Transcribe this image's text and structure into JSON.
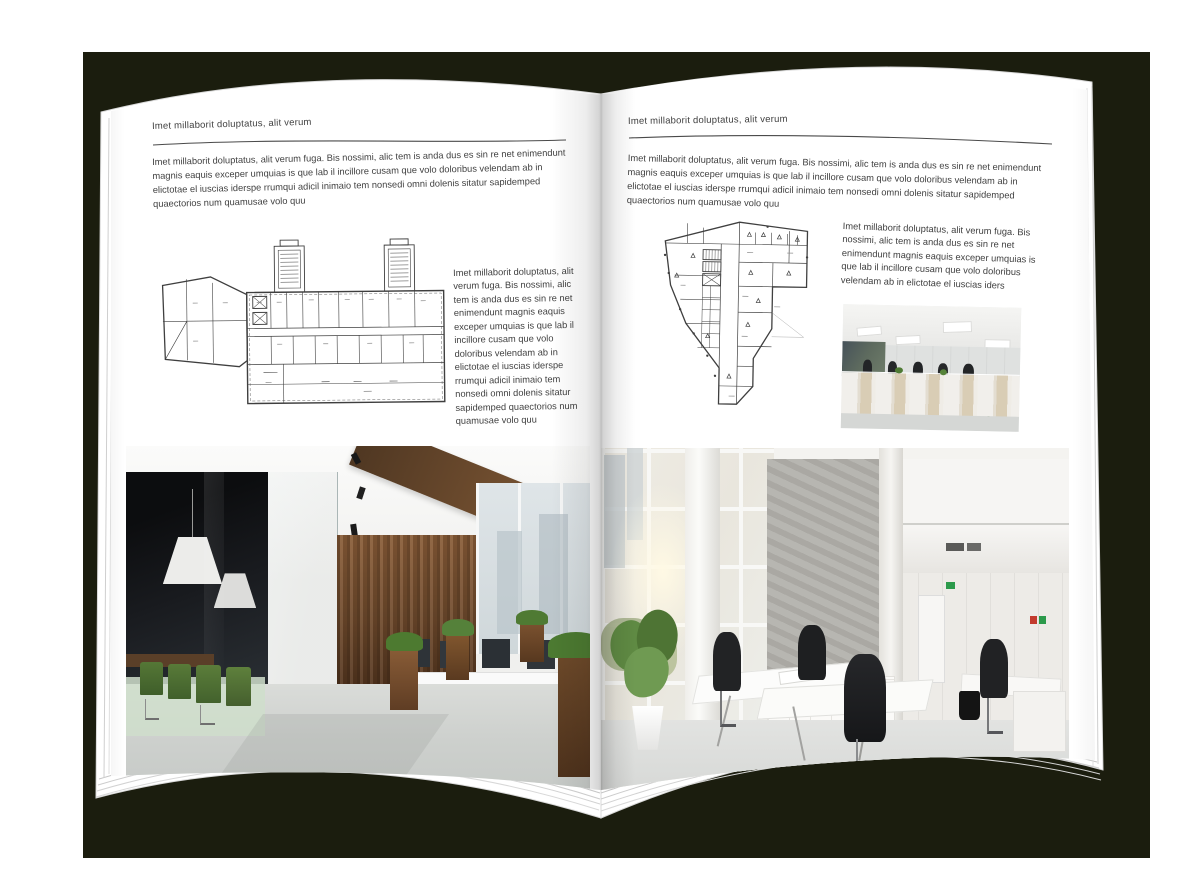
{
  "mockup": {
    "kind": "open-brochure-spread",
    "colors": {
      "backdrop": "#1b1d0e",
      "page": "#ffffff",
      "ink": "#3f3f3f",
      "rule": "#4a4a4a"
    }
  },
  "left_page": {
    "header": "Imet millaborit doluptatus, alit verum",
    "intro": "Imet millaborit doluptatus, alit verum fuga. Bis nossimi, alic tem is anda dus es sin re net enimendunt magnis eaquis exceper umquias is que lab il incillore cusam que volo doloribus velendam ab in elictotae el iuscias iderspe rrumqui adicil inimaio tem nonsedi omni dolenis sitatur sapidemped quaectorios num quamusae volo quu",
    "side_text": "Imet millaborit doluptatus, alit verum fuga. Bis nossimi, alic tem is anda dus es sin re net enimendunt magnis eaquis exceper umquias is que lab il incillore cusam que volo doloribus velendam ab in elictotae el iuscias iderspe rrumqui adicil inimaio tem nonsedi omni dolenis sitatur sapidemped quaectorios num quamusae volo quu",
    "floor_plan_name": "wide-building-floor-plan",
    "photo_name": "loft-office-interior-photo"
  },
  "right_page": {
    "header": "Imet millaborit doluptatus, alit verum",
    "intro": "Imet millaborit doluptatus, alit verum fuga. Bis nossimi, alic tem is anda dus es sin re net enimendunt magnis eaquis exceper umquias is que lab il incillore cusam que volo doloribus velendam ab in elictotae el iuscias iderspe rrumqui adicil inimaio tem nonsedi omni dolenis sitatur sapidemped quaectorios num quamusae volo quu",
    "side_text": "Imet millaborit doluptatus, alit verum fuga. Bis nossimi, alic tem is anda dus es sin re net enimendunt magnis eaquis exceper umquias is que lab il incillore cusam que volo doloribus velendam ab in elictotae el iuscias iders",
    "floor_plan_name": "irregular-building-floor-plan",
    "photo_small_name": "open-office-workstations-photo",
    "photo_large_name": "atrium-office-interior-photo"
  }
}
